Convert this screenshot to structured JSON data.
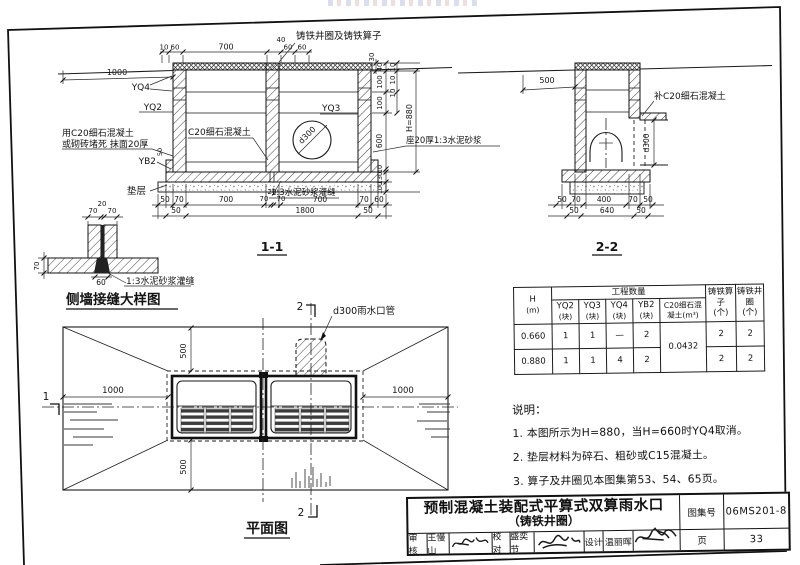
{
  "s11": {
    "title": "1-1",
    "lbl": {
      "grate": "铸铁井圈及铸铁算子",
      "yq4": "YQ4",
      "yq2": "YQ2",
      "yq3": "YQ3",
      "yb2": "YB2",
      "seal1": "用C20细石混凝土",
      "seal2": "或砌砖堵死 抹面20厚",
      "infill": "C20细石混凝土",
      "pipe": "d300",
      "seat": "座20厚1:3水泥砂浆",
      "bedding": "垫层",
      "grout": "1:3水泥砂浆灌缝"
    },
    "dim": {
      "left": "1000",
      "top": [
        "10",
        "60",
        "700",
        "40",
        "60",
        "60"
      ],
      "right": [
        "30",
        "40",
        "100",
        "100",
        "10",
        "10",
        "10",
        "600",
        "10",
        "130",
        "100",
        "H=880"
      ],
      "b1": [
        "50",
        "70",
        "700",
        "70",
        "20",
        "70",
        "700",
        "70",
        "60"
      ],
      "b2": [
        "50",
        "1800",
        "50"
      ],
      "yb2h": "50"
    }
  },
  "s22": {
    "title": "2-2",
    "lbl": {
      "patch": "补C20细石混凝土",
      "pipe": "d300"
    },
    "dim": {
      "top": "500",
      "b1": [
        "50",
        "70",
        "400",
        "70",
        "50"
      ],
      "b2": [
        "50",
        "640",
        "50"
      ]
    }
  },
  "joint": {
    "title": "侧墙接缝大样图",
    "grout": "1:3水泥砂浆灌缝",
    "dim": {
      "t1": "70",
      "t2": "20",
      "t3": "70",
      "left": "70",
      "bottom": "60"
    }
  },
  "plan": {
    "title": "平面图",
    "pipe": "d300雨水口管",
    "m1": "1",
    "m2": "2",
    "dim": {
      "t": "500",
      "l": "1000",
      "r": "1000",
      "b": "500"
    }
  },
  "table": {
    "h1": "H",
    "h2": "(m)",
    "qty": "工程数量",
    "cols": [
      {
        "a": "YQ2",
        "b": "(块)"
      },
      {
        "a": "YQ3",
        "b": "(块)"
      },
      {
        "a": "YQ4",
        "b": "(块)"
      },
      {
        "a": "YB2",
        "b": "(块)"
      },
      {
        "a": "C20细石混",
        "b": "凝土(m³)"
      }
    ],
    "grate": {
      "a": "铸铁算子",
      "b": "(个)"
    },
    "ring": {
      "a": "铸铁井圈",
      "b": "(个)"
    },
    "c20": "0.0432",
    "rows": [
      {
        "h": "0.660",
        "v": [
          "1",
          "1",
          "—",
          "2"
        ],
        "g": "2",
        "r": "2"
      },
      {
        "h": "0.880",
        "v": [
          "1",
          "1",
          "4",
          "2"
        ],
        "g": "2",
        "r": "2"
      }
    ]
  },
  "notes": {
    "head": "说明：",
    "items": [
      "1. 本图所示为H=880，当H=660时YQ4取消。",
      "2. 垫层材料为碎石、粗砂或C15混凝土。",
      "3. 算子及井圈见本图集第53、54、65页。"
    ]
  },
  "tb": {
    "t1": "预制混凝土装配式平算式双算雨水口",
    "t2": "（铸铁井圈）",
    "atlas_label": "图集号",
    "atlas_no": "06MS201-8",
    "page_label": "页",
    "page_no": "33",
    "r_label": "审核",
    "r_name": "王慢山",
    "c_label": "校对",
    "c_name": "盛奕节",
    "d_label": "设计",
    "d_name": "温丽晖"
  }
}
